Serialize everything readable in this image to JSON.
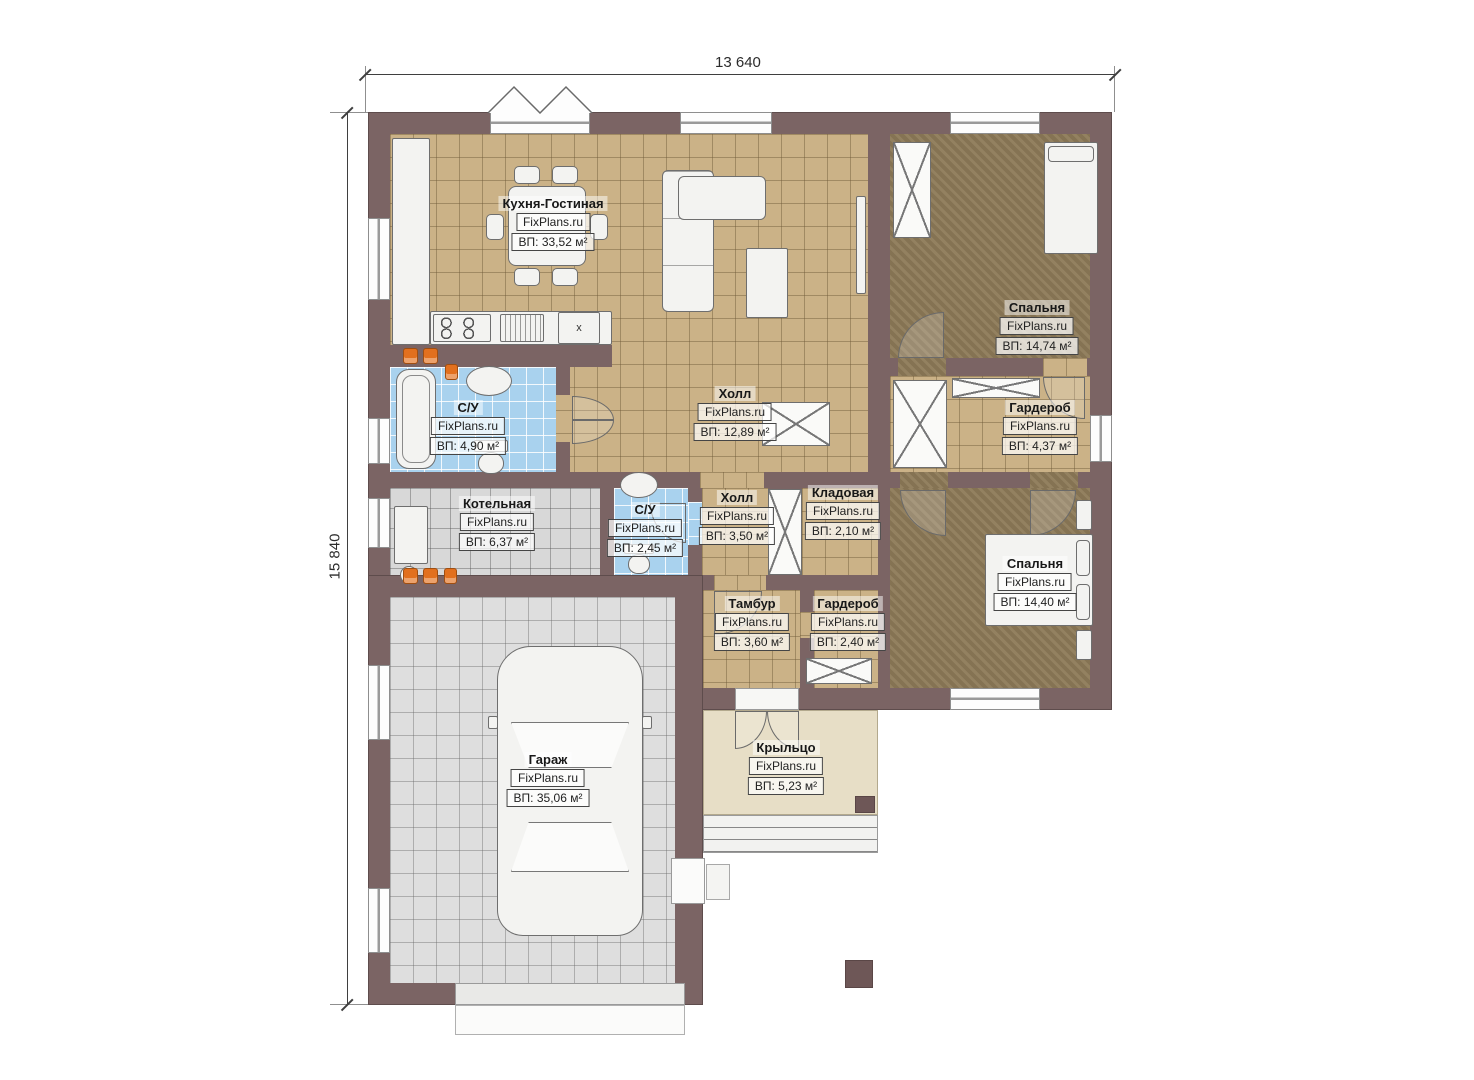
{
  "dimensions": {
    "width_label": "13 640",
    "height_label": "15 840"
  },
  "brand": {
    "label": "FixPlans.ru"
  },
  "rooms": [
    {
      "id": "kitchen-living",
      "name": "Кухня-Гостиная",
      "area": "ВП: 33,52 м²"
    },
    {
      "id": "bedroom-1",
      "name": "Спальня",
      "area": "ВП: 14,74 м²"
    },
    {
      "id": "bathroom-1",
      "name": "С/У",
      "area": "ВП: 4,90 м²"
    },
    {
      "id": "hall-main",
      "name": "Холл",
      "area": "ВП: 12,89 м²"
    },
    {
      "id": "wardrobe-1",
      "name": "Гардероб",
      "area": "ВП: 4,37 м²"
    },
    {
      "id": "boiler-room",
      "name": "Котельная",
      "area": "ВП: 6,37 м²"
    },
    {
      "id": "bathroom-2",
      "name": "С/У",
      "area": "ВП: 2,45 м²"
    },
    {
      "id": "hall-2",
      "name": "Холл",
      "area": "ВП: 3,50 м²"
    },
    {
      "id": "storage",
      "name": "Кладовая",
      "area": "ВП: 2,10 м²"
    },
    {
      "id": "vestibule",
      "name": "Тамбур",
      "area": "ВП: 3,60 м²"
    },
    {
      "id": "wardrobe-2",
      "name": "Гардероб",
      "area": "ВП: 2,40 м²"
    },
    {
      "id": "bedroom-2",
      "name": "Спальня",
      "area": "ВП: 14,40 м²"
    },
    {
      "id": "garage",
      "name": "Гараж",
      "area": "ВП: 35,06 м²"
    },
    {
      "id": "porch",
      "name": "Крыльцо",
      "area": "ВП: 5,23 м²"
    }
  ],
  "kitchen": {
    "fridge_label": "x"
  },
  "colors": {
    "wall": "#7b6464",
    "floor_tile_tan": "#cbb287",
    "floor_wood_brown": "#8d7a58",
    "floor_tile_blue": "#a9d2ee",
    "floor_tile_gray": "#d8d8d8",
    "floor_porch_beige": "#e7dec6",
    "radiator_orange": "#e2701e"
  }
}
